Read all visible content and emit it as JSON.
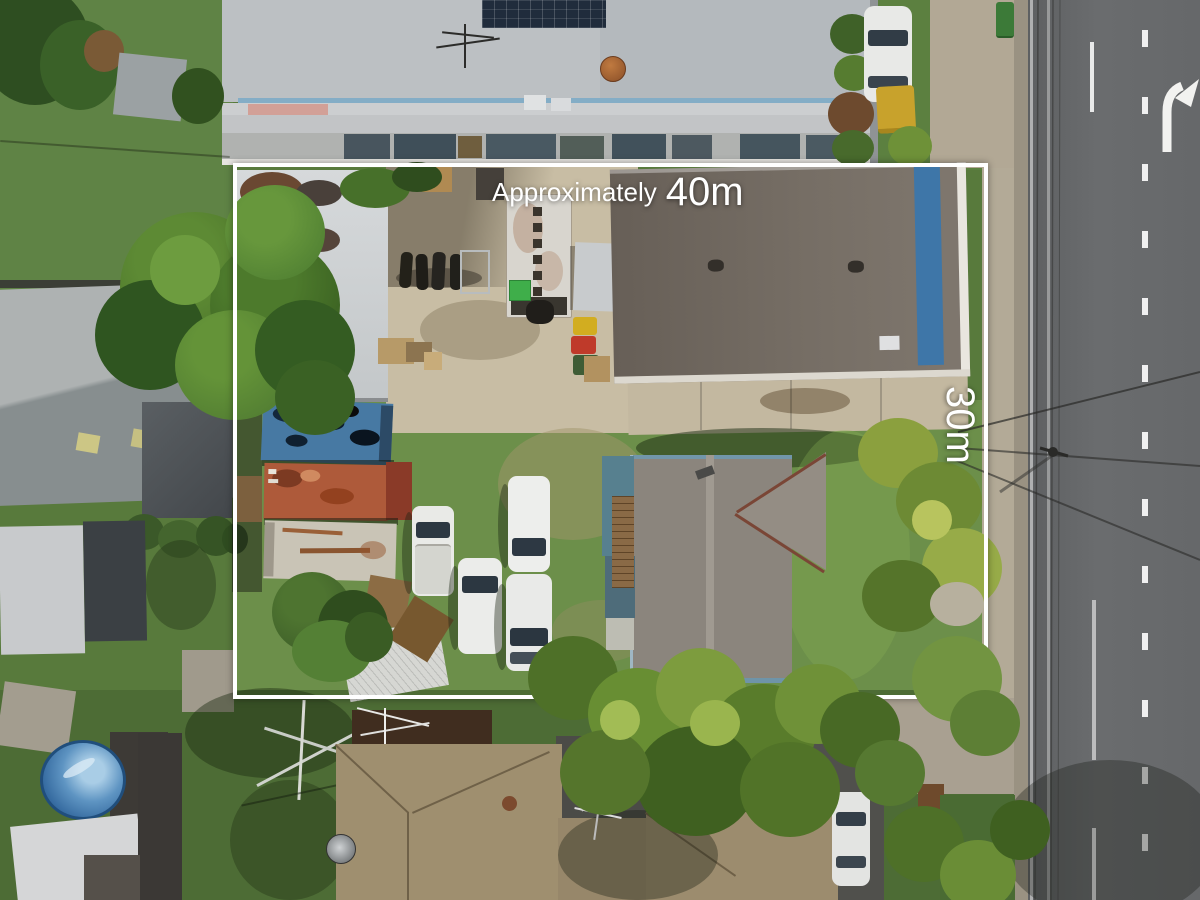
{
  "annotation": {
    "top_label": {
      "prefix": "Approximately",
      "value": "40m"
    },
    "right_label": "30m"
  },
  "colors": {
    "boundary": "#ffffff",
    "lawn": "#587a3c",
    "road": "#67696b",
    "concrete_yard": "#c8bda4",
    "footpath": "#b3aa97",
    "shed_roof": "#6f6860",
    "house_roof": "#8b857d",
    "workshop_roof": "#d0d4d6",
    "container_blue": "#4779a3",
    "container_orange": "#ae5a3a",
    "container_white": "#c9c4b6",
    "pool_blue": "#4c84b4",
    "tile_roof": "#9f8f6f"
  },
  "scene": {
    "objects": [
      "industrial-building-roof",
      "solar-panels",
      "workshop-roof",
      "large-shed-roof",
      "concrete-yard",
      "motorbikes",
      "box-truck",
      "wheelie-bins",
      "shipping-container-blue",
      "shipping-container-orange",
      "shipping-container-white",
      "white-vans",
      "house-roof",
      "gable-wing",
      "palm-trees",
      "large-tree",
      "road",
      "lane-markings",
      "turn-arrow",
      "power-lines",
      "above-ground-pool",
      "tile-roof-houses",
      "parked-cars",
      "property-boundary"
    ]
  }
}
